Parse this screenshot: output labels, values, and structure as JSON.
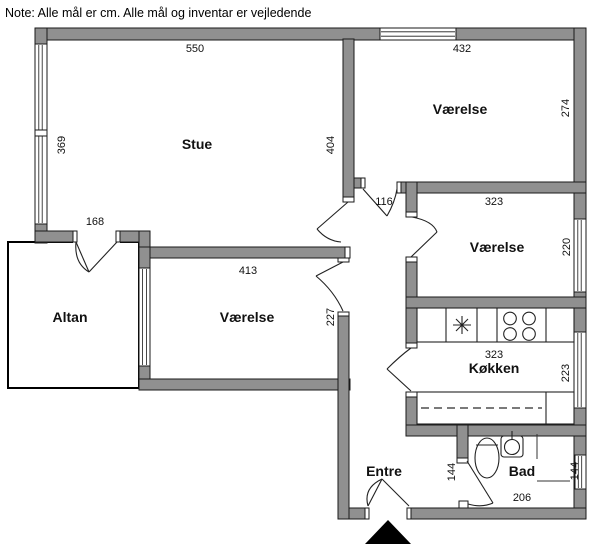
{
  "note": "Note: Alle mål er cm. Alle mål og inventar er vejledende",
  "colors": {
    "wall": "#909090",
    "background": "#ffffff",
    "line": "#000000"
  },
  "rooms": {
    "stue": {
      "name": "Stue",
      "dim_width": "550",
      "dim_height_left": "369",
      "dim_height_right": "404",
      "dim_balcony_door": "168"
    },
    "vaerelse_top": {
      "name": "Værelse",
      "dim_width": "432",
      "dim_height": "274"
    },
    "vaerelse_mid": {
      "name": "Værelse",
      "dim_width": "323",
      "dim_height": "220"
    },
    "vaerelse_bottom": {
      "name": "Værelse",
      "dim_width": "413",
      "dim_height": "227"
    },
    "koekken": {
      "name": "Køkken",
      "dim_width": "323",
      "dim_height": "223"
    },
    "altan": {
      "name": "Altan"
    },
    "entre": {
      "name": "Entre"
    },
    "bad": {
      "name": "Bad",
      "dim_left": "144",
      "dim_window": "144",
      "dim_width": "206"
    }
  },
  "hallway": {
    "dim_opening": "116"
  }
}
